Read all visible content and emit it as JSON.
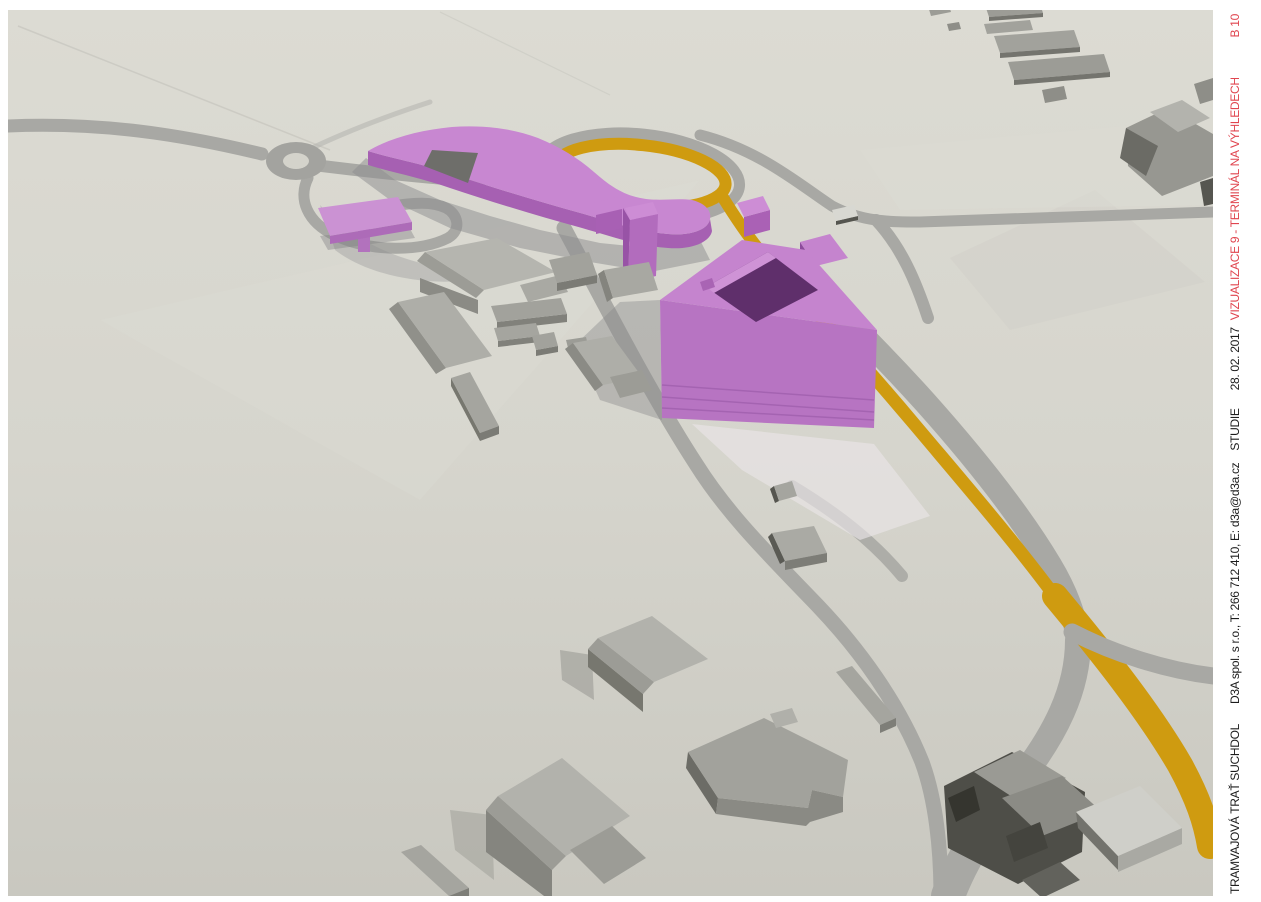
{
  "sheet": {
    "title_block": {
      "project": "TRAMVAJOVÁ TRAŤ SUCHDOL",
      "company": "D3A spol. s r.o., T: 266 712 410, E: d3a@d3a.cz",
      "phase": "STUDIE",
      "date": "28. 02. 2017",
      "drawing_title": "VIZUALIZACE 9 - TERMINÁL NA VÝHLEDECH",
      "drawing_number": "B 10"
    },
    "colors": {
      "accent_red": "#e0454f",
      "text_black": "#1c1c1c",
      "paper_white": "#ffffff",
      "ground": "#d6d5cd",
      "road_gray": "#a8a8a4",
      "tram_route_orange": "#cf9b10",
      "proposed_building_pink": "#c584ce",
      "existing_building_gray": "#9a9a94"
    }
  }
}
